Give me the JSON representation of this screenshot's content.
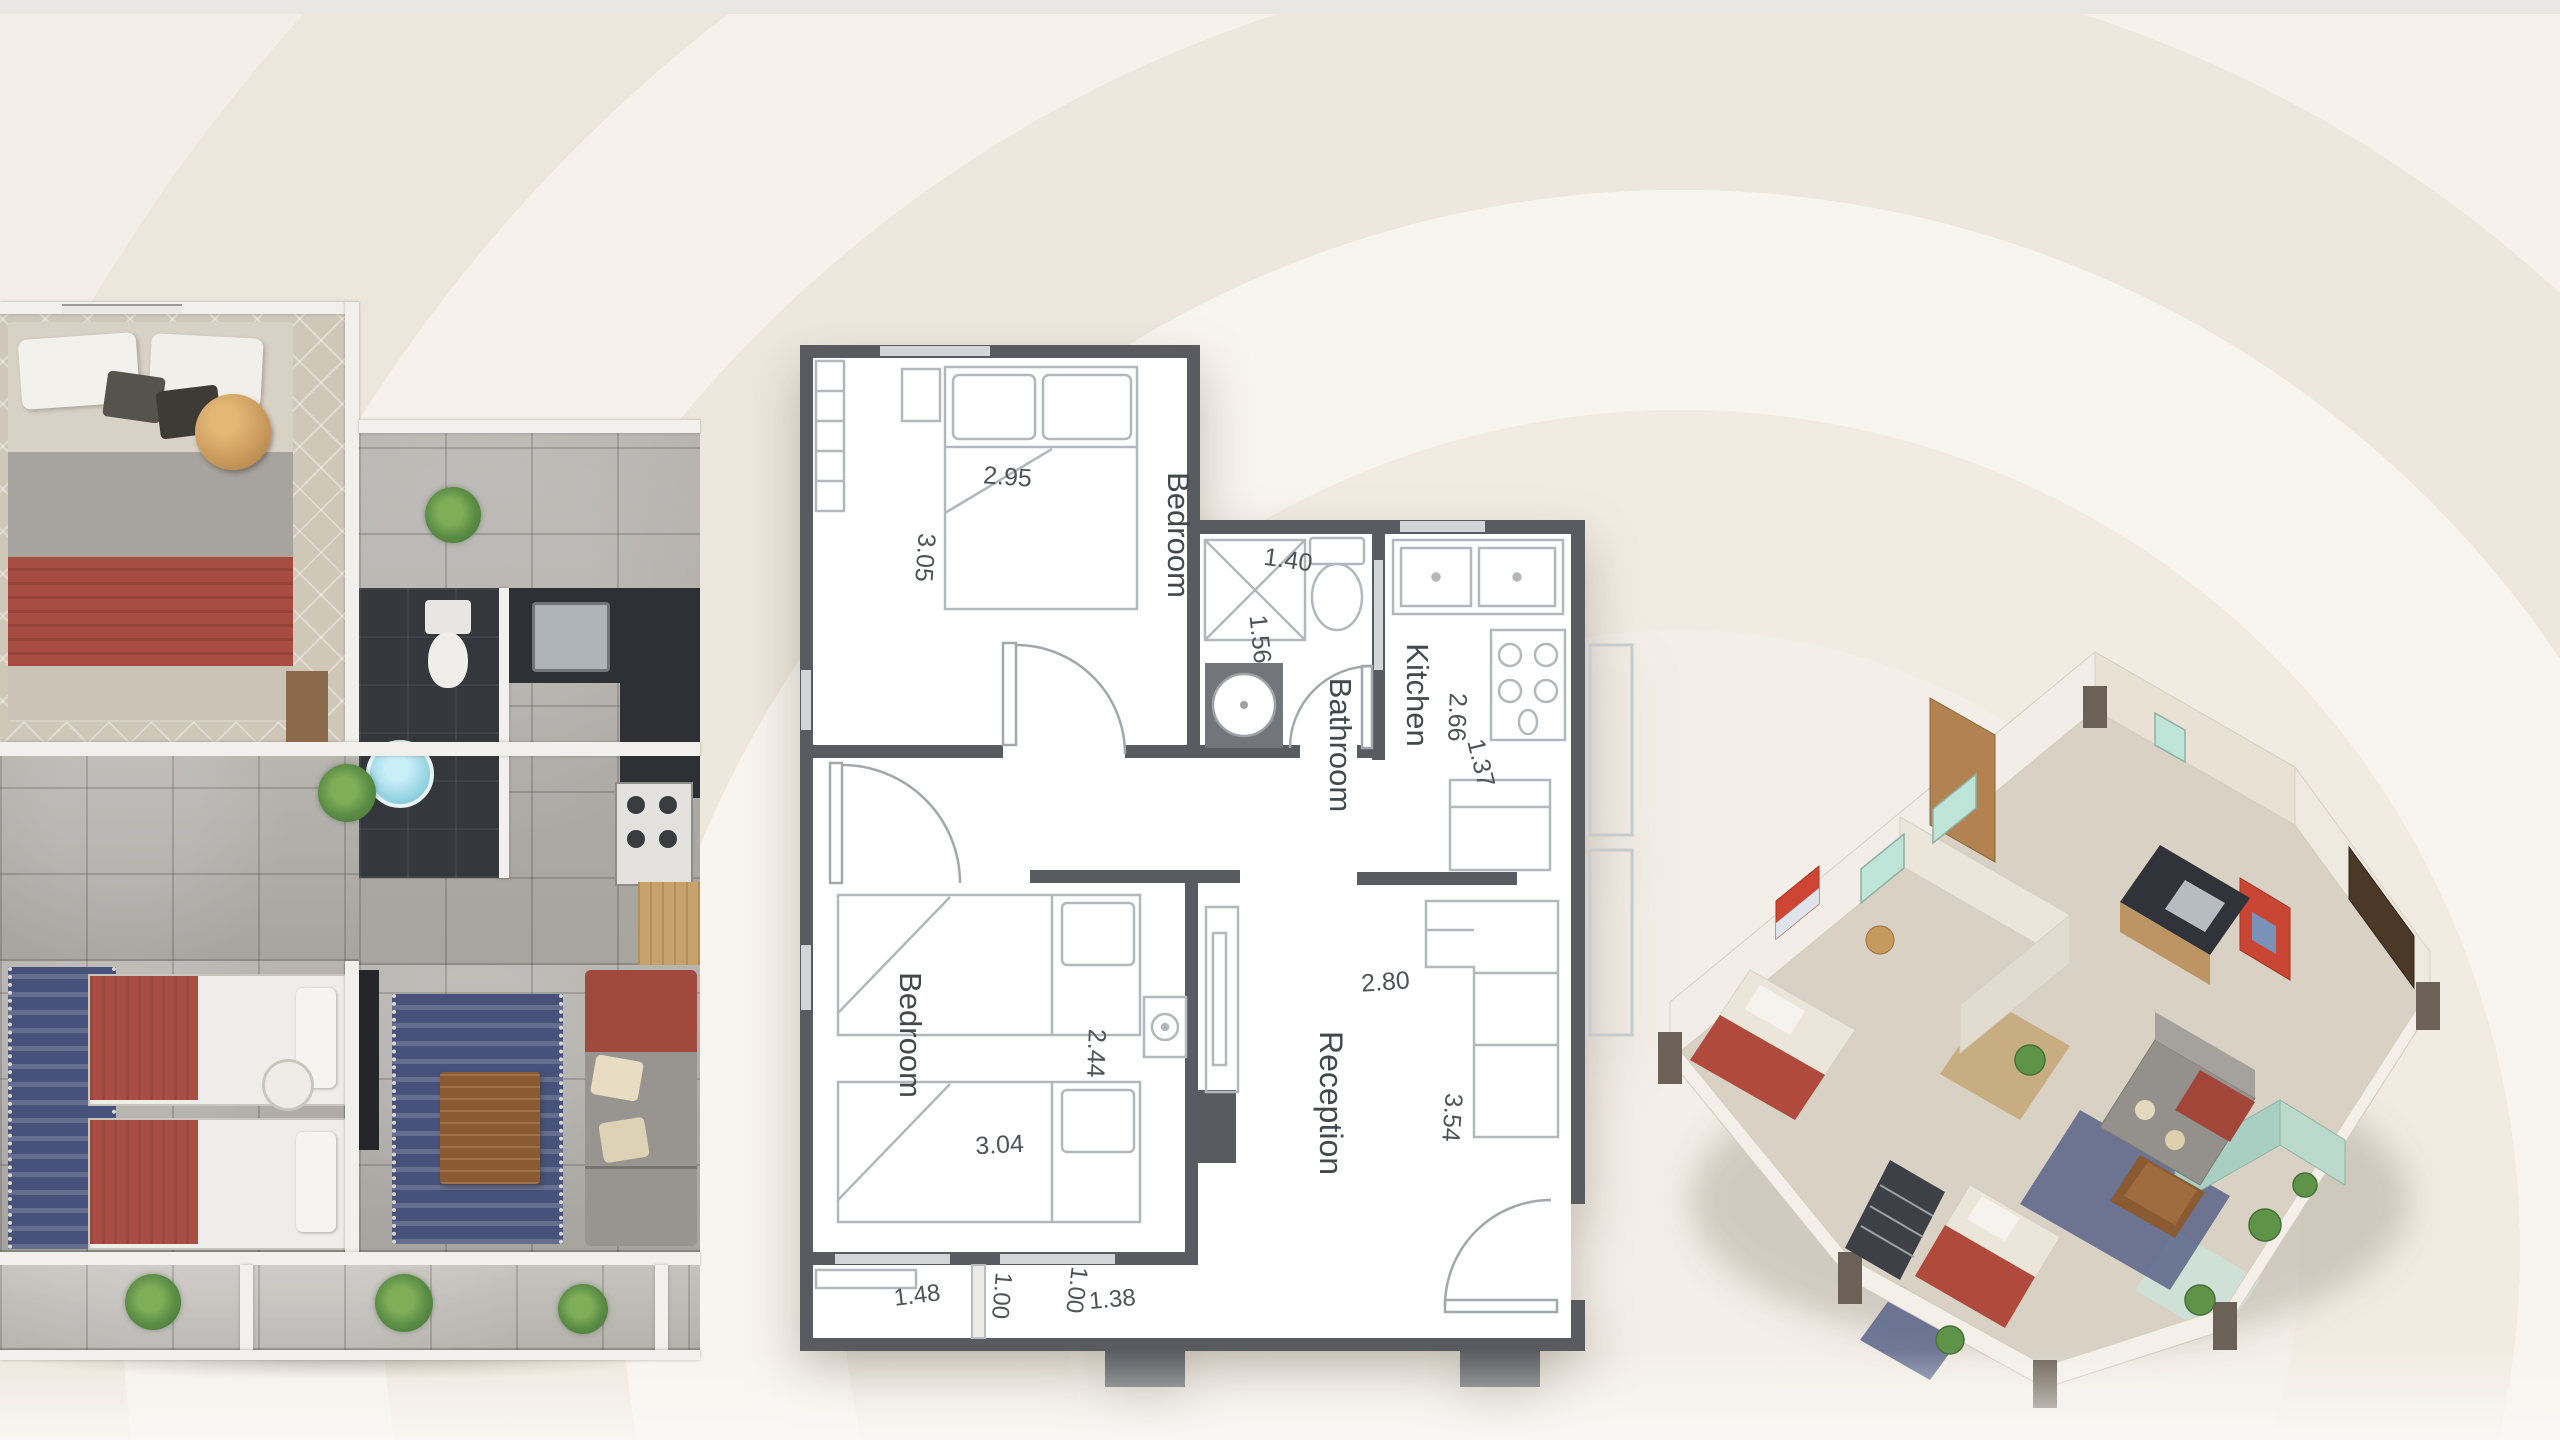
{
  "scene": {
    "background": "#f3eee7",
    "top_strip_color": "#e8e7e4",
    "wall_color": "#585c60",
    "dimension_text_color": "#4f5356",
    "room_label_color": "#43484d",
    "accent_red": "#a84e43",
    "rug_blue": "#47527a"
  },
  "center_plan": {
    "bedroom1": {
      "label": "Bedroom",
      "dim_width": "2.95",
      "dim_height": "3.05"
    },
    "bathroom": {
      "label": "Bathroom",
      "dim_width": "1.40",
      "dim_height": "1.56"
    },
    "kitchen": {
      "label": "Kitchen",
      "dim_depth": "2.66",
      "dim_width": "1.37"
    },
    "bedroom2": {
      "label": "Bedroom",
      "dim_width": "3.04",
      "dim_height": "2.44"
    },
    "reception": {
      "label": "Reception",
      "dim_width": "2.80",
      "dim_height": "3.54"
    },
    "balcony": {
      "dims": [
        "1.48",
        "1.00",
        "1.00",
        "1.38"
      ]
    }
  }
}
